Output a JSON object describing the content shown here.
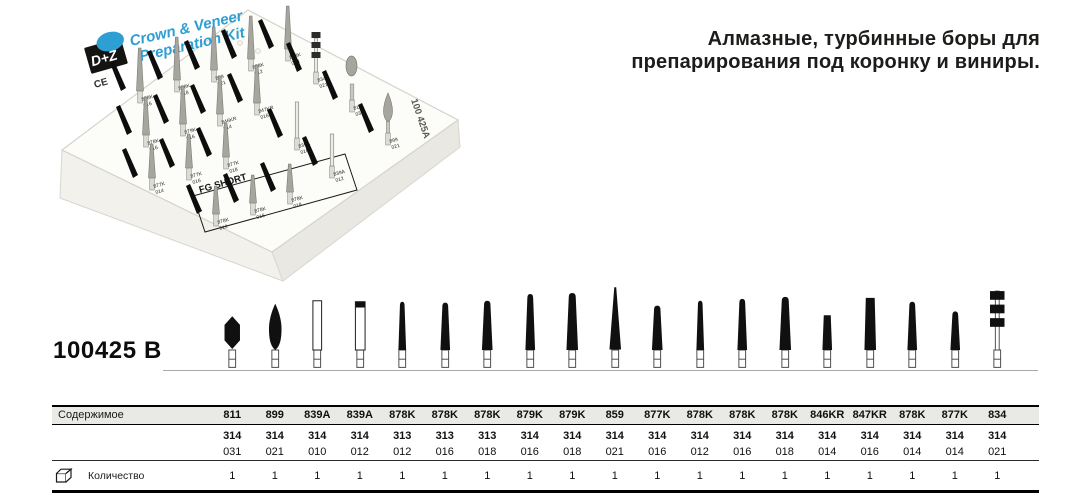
{
  "heading": {
    "line1": "Алмазные, турбинные боры для",
    "line2": "препарирования под коронку и виниры."
  },
  "product_code": "100425 B",
  "colors": {
    "accent_blue": "#2d9fd3",
    "bur_black": "#101010",
    "header_bg": "#e9e9e5",
    "box_white": "#fcfcf9"
  },
  "photo": {
    "title_line1": "Crown & Veneer",
    "title_line2": "Preparation Kit",
    "logo_text": "D+Z",
    "ce_text": "CE",
    "fg_short_label": "FG SHORT",
    "side_code": "100 425A",
    "pins": [
      {
        "x": 140,
        "y": 103,
        "h": 55,
        "code": "878K",
        "size": "016",
        "type": "cone"
      },
      {
        "x": 177,
        "y": 92,
        "h": 55,
        "code": "878K",
        "size": "018",
        "type": "cone"
      },
      {
        "x": 214,
        "y": 82,
        "h": 55,
        "code": "899",
        "size": "021",
        "type": "cone"
      },
      {
        "x": 251,
        "y": 71,
        "h": 55,
        "code": "878K",
        "size": "012",
        "type": "cone"
      },
      {
        "x": 288,
        "y": 61,
        "h": 55,
        "code": "878K",
        "size": "014",
        "type": "cone"
      },
      {
        "x": 146,
        "y": 147,
        "h": 50,
        "code": "878K",
        "size": "016",
        "type": "cone"
      },
      {
        "x": 183,
        "y": 136,
        "h": 50,
        "code": "879K",
        "size": "016",
        "type": "cone"
      },
      {
        "x": 220,
        "y": 126,
        "h": 50,
        "code": "846KR",
        "size": "014",
        "type": "cone"
      },
      {
        "x": 257,
        "y": 115,
        "h": 50,
        "code": "847KR",
        "size": "016",
        "type": "cone"
      },
      {
        "x": 316,
        "y": 84,
        "h": 52,
        "code": "834",
        "size": "021",
        "type": "discs"
      },
      {
        "x": 152,
        "y": 190,
        "h": 46,
        "code": "877K",
        "size": "014",
        "type": "cone"
      },
      {
        "x": 189,
        "y": 180,
        "h": 46,
        "code": "877K",
        "size": "016",
        "type": "cone"
      },
      {
        "x": 226,
        "y": 169,
        "h": 46,
        "code": "877K",
        "size": "018",
        "type": "cone"
      },
      {
        "x": 297,
        "y": 150,
        "h": 48,
        "code": "839A",
        "size": "010",
        "type": "slim"
      },
      {
        "x": 352,
        "y": 112,
        "h": 55,
        "code": "811",
        "size": "031",
        "type": "round"
      },
      {
        "x": 216,
        "y": 226,
        "h": 40,
        "code": "878K",
        "size": "012",
        "type": "cone"
      },
      {
        "x": 253,
        "y": 215,
        "h": 40,
        "code": "878K",
        "size": "016",
        "type": "cone"
      },
      {
        "x": 290,
        "y": 204,
        "h": 40,
        "code": "878K",
        "size": "018",
        "type": "cone"
      },
      {
        "x": 332,
        "y": 178,
        "h": 44,
        "code": "839A",
        "size": "012",
        "type": "slim"
      },
      {
        "x": 388,
        "y": 145,
        "h": 52,
        "code": "899",
        "size": "021",
        "type": "flame"
      }
    ]
  },
  "table": {
    "contents_label": "Содержимое",
    "quantity_label": "Количество",
    "columns": [
      {
        "code": "811",
        "iso": "314",
        "size": "031",
        "qty": "1",
        "shape": "hex",
        "w": 16,
        "top": 42
      },
      {
        "code": "899",
        "iso": "314",
        "size": "021",
        "qty": "1",
        "shape": "flame",
        "w": 13,
        "top": 29
      },
      {
        "code": "839A",
        "iso": "314",
        "size": "010",
        "qty": "1",
        "shape": "cyl",
        "w": 9,
        "top": 26
      },
      {
        "code": "839A",
        "iso": "314",
        "size": "012",
        "qty": "1",
        "shape": "cyl_tip",
        "w": 10,
        "top": 27
      },
      {
        "code": "878K",
        "iso": "313",
        "size": "012",
        "qty": "1",
        "shape": "torpedo",
        "w": 8,
        "top": 27
      },
      {
        "code": "878K",
        "iso": "313",
        "size": "016",
        "qty": "1",
        "shape": "torpedo",
        "w": 10,
        "top": 28
      },
      {
        "code": "878K",
        "iso": "313",
        "size": "018",
        "qty": "1",
        "shape": "torpedo",
        "w": 11,
        "top": 26
      },
      {
        "code": "879K",
        "iso": "314",
        "size": "016",
        "qty": "1",
        "shape": "torpedo",
        "w": 10,
        "top": 19
      },
      {
        "code": "879K",
        "iso": "314",
        "size": "018",
        "qty": "1",
        "shape": "torpedo",
        "w": 12,
        "top": 18
      },
      {
        "code": "859",
        "iso": "314",
        "size": "021",
        "qty": "1",
        "shape": "needle",
        "w": 12,
        "top": 12
      },
      {
        "code": "877K",
        "iso": "314",
        "size": "016",
        "qty": "1",
        "shape": "torpedo",
        "w": 11,
        "top": 31
      },
      {
        "code": "878K",
        "iso": "314",
        "size": "012",
        "qty": "1",
        "shape": "torpedo",
        "w": 8,
        "top": 26
      },
      {
        "code": "878K",
        "iso": "314",
        "size": "016",
        "qty": "1",
        "shape": "torpedo",
        "w": 10,
        "top": 24
      },
      {
        "code": "878K",
        "iso": "314",
        "size": "018",
        "qty": "1",
        "shape": "torpedo",
        "w": 12,
        "top": 22
      },
      {
        "code": "846KR",
        "iso": "314",
        "size": "014",
        "qty": "1",
        "shape": "flat",
        "w": 10,
        "top": 41
      },
      {
        "code": "847KR",
        "iso": "314",
        "size": "016",
        "qty": "1",
        "shape": "flat",
        "w": 12,
        "top": 23
      },
      {
        "code": "878K",
        "iso": "314",
        "size": "014",
        "qty": "1",
        "shape": "torpedo",
        "w": 10,
        "top": 27
      },
      {
        "code": "877K",
        "iso": "314",
        "size": "014",
        "qty": "1",
        "shape": "torpedo",
        "w": 10,
        "top": 37
      },
      {
        "code": "834",
        "iso": "314",
        "size": "021",
        "qty": "1",
        "shape": "discs",
        "w": 15,
        "top": 16
      }
    ]
  }
}
